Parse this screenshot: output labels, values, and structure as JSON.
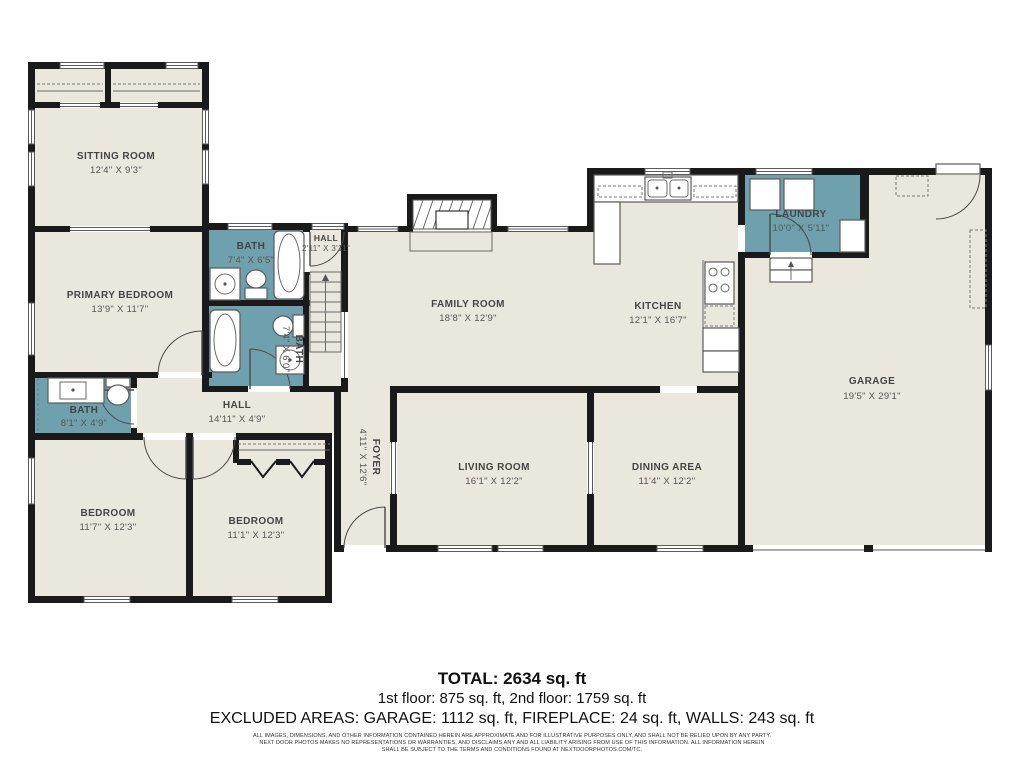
{
  "plan": {
    "colors": {
      "floor": "#eae7dc",
      "wet_room": "#6fa0ae",
      "wall": "#1a1a1a"
    },
    "rooms": {
      "sitting": {
        "name": "SITTING ROOM",
        "dims": "12'4\" X 9'3\""
      },
      "primary": {
        "name": "PRIMARY BEDROOM",
        "dims": "13'9\" X 11'7\""
      },
      "bath_up": {
        "name": "BATH",
        "dims": "7'4\" X 6'5\""
      },
      "hall_up": {
        "name": "HALL",
        "dims": "2'11\" X 3'11\""
      },
      "bath_mid": {
        "name": "BATH",
        "dims": "7'4\" X 6'0\""
      },
      "bath_left": {
        "name": "BATH",
        "dims": "8'1\" X 4'9\""
      },
      "hall": {
        "name": "HALL",
        "dims": "14'11\" X 4'9\""
      },
      "bed1": {
        "name": "BEDROOM",
        "dims": "11'7\" X 12'3\""
      },
      "bed2": {
        "name": "BEDROOM",
        "dims": "11'1\" X 12'3\""
      },
      "family": {
        "name": "FAMILY ROOM",
        "dims": "18'8\" X 12'9\""
      },
      "kitchen": {
        "name": "KITCHEN",
        "dims": "12'1\" X 16'7\""
      },
      "laundry": {
        "name": "LAUNDRY",
        "dims": "10'0\" X 5'11\""
      },
      "garage": {
        "name": "GARAGE",
        "dims": "19'5\" X 29'1\""
      },
      "foyer": {
        "name": "FOYER",
        "dims": "4'11\" X 12'6\""
      },
      "living": {
        "name": "LIVING ROOM",
        "dims": "16'1\" X 12'2\""
      },
      "dining": {
        "name": "DINING AREA",
        "dims": "11'4\" X 12'2\""
      }
    }
  },
  "summary": {
    "total": "TOTAL: 2634 sq. ft",
    "floors": "1st floor: 875 sq. ft, 2nd floor: 1759 sq. ft",
    "excluded": "EXCLUDED AREAS: GARAGE: 1112 sq. ft, FIREPLACE: 24 sq. ft, WALLS: 243 sq. ft",
    "disclaimer_1": "ALL IMAGES, DIMENSIONS, AND OTHER INFORMATION CONTAINED HEREIN ARE APPROXIMATE AND FOR ILLUSTRATIVE PURPOSES ONLY, AND SHALL NOT BE RELIED UPON BY ANY PARTY.",
    "disclaimer_2": "NEXT DOOR PHOTOS MAKES NO REPRESENTATIONS OR WARRANTIES, AND DISCLAIMS ANY AND ALL LIABILITY ARISING FROM USE OF THIS INFORMATION. ALL INFORMATION HEREIN",
    "disclaimer_3": "SHALL BE SUBJECT TO THE TERMS AND CONDITIONS FOUND AT NEXTDOORPHOTOS.COM/TC."
  }
}
